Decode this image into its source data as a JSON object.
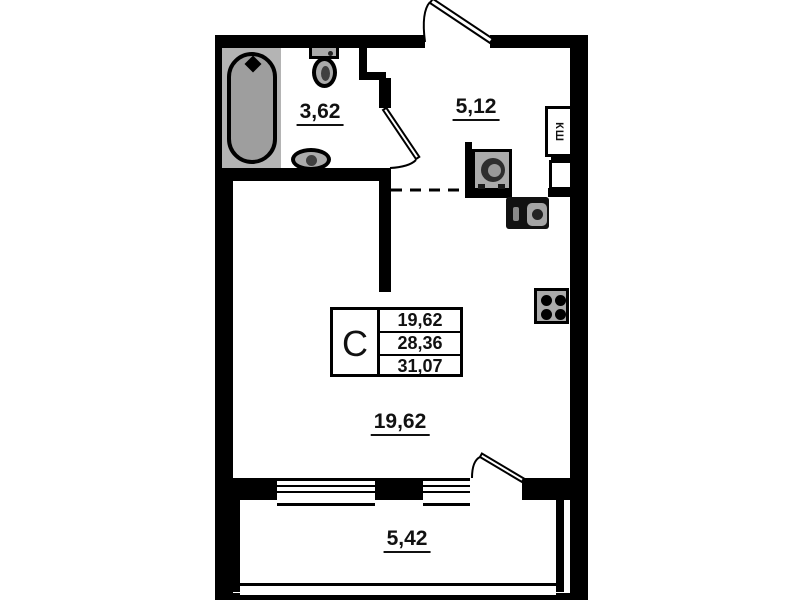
{
  "plan_title": "studio-apartment-floor-plan",
  "rooms": {
    "bathroom": {
      "area": "3,62"
    },
    "hall": {
      "area": "5,12"
    },
    "living": {
      "area": "19,62"
    },
    "balcony": {
      "area": "5,42"
    }
  },
  "info_table": {
    "type": "С",
    "rows": [
      "19,62",
      "28,36",
      "31,07"
    ]
  },
  "shaft": {
    "label": "КШ"
  },
  "colors": {
    "wall": "#000000",
    "background": "#ffffff",
    "fixture": "#ababab",
    "fixture-dark": "#2e2e2e",
    "platform": "#b4b4b4",
    "tub": "#9e9e9e",
    "text": "#111111"
  }
}
